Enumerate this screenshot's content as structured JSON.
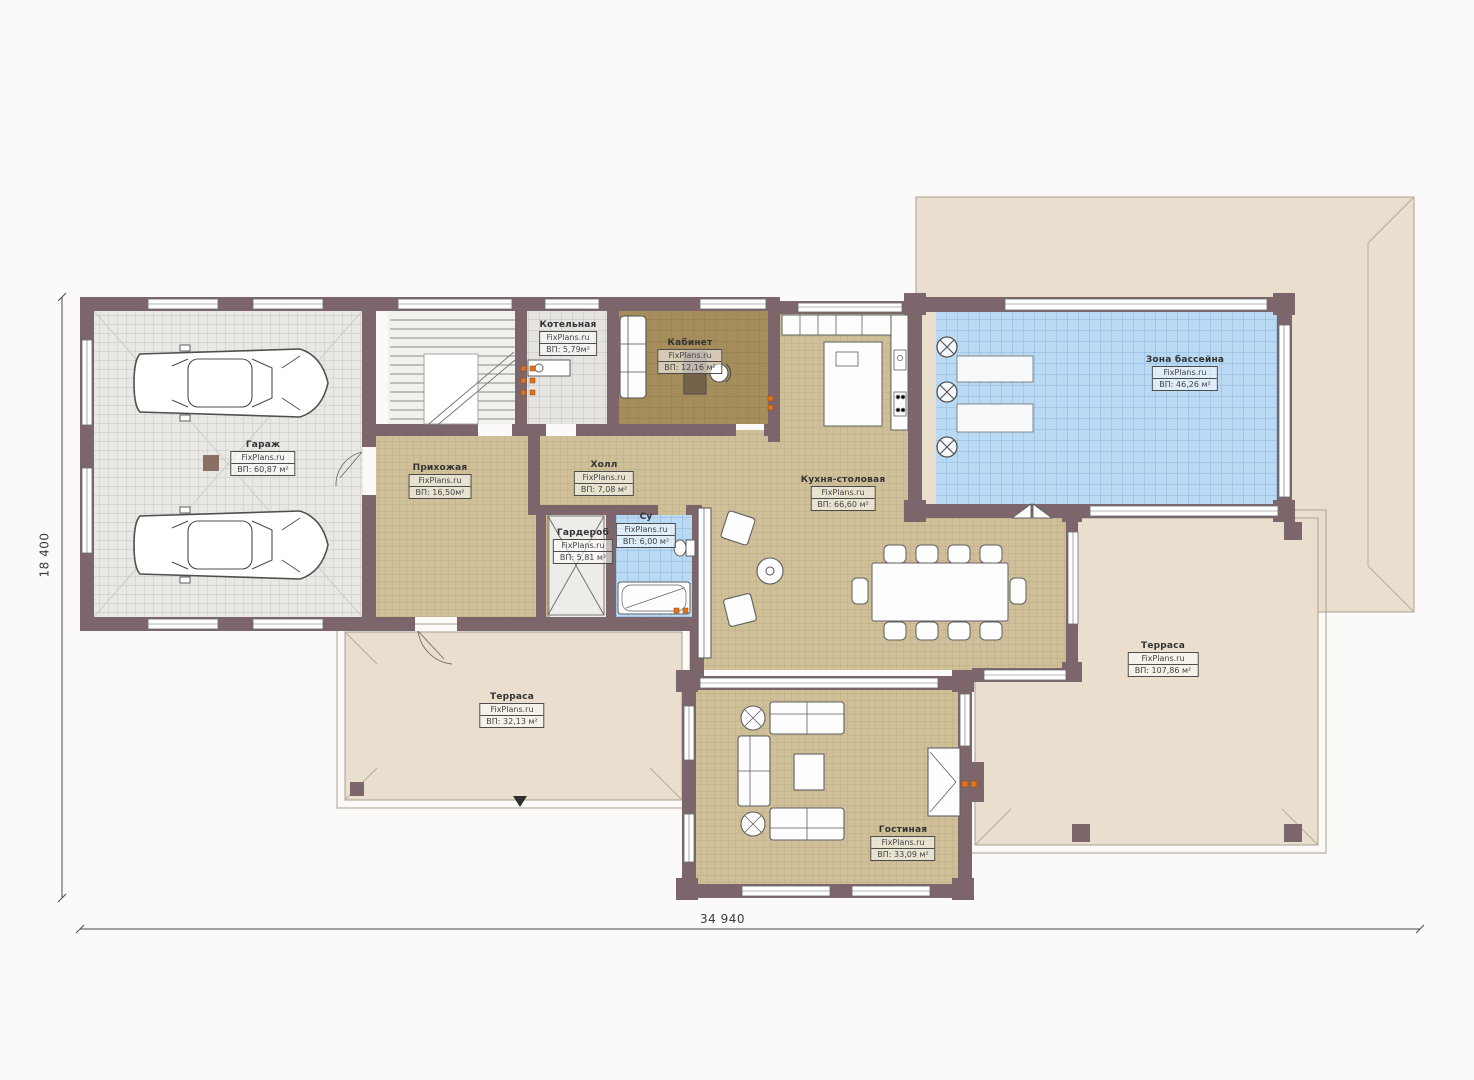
{
  "plan": {
    "brand": "FixPlans.ru",
    "dimensions": {
      "width": "34 940",
      "height": "18 400"
    },
    "rooms": [
      {
        "id": "garage",
        "name": "Гараж",
        "area": "ВП: 60,87 м²"
      },
      {
        "id": "boiler",
        "name": "Котельная",
        "area": "ВП: 5,79м²"
      },
      {
        "id": "office",
        "name": "Кабинет",
        "area": "ВП: 12,16 м²"
      },
      {
        "id": "entry",
        "name": "Прихожая",
        "area": "ВП: 16,50м²"
      },
      {
        "id": "hall",
        "name": "Холл",
        "area": "ВП: 7,08 м²"
      },
      {
        "id": "wardrobe",
        "name": "Гардероб",
        "area": "ВП: 5,81 м²"
      },
      {
        "id": "wc",
        "name": "Су",
        "area": "ВП: 6,00 м²"
      },
      {
        "id": "kitchen",
        "name": "Кухня-столовая",
        "area": "ВП: 66,60 м²"
      },
      {
        "id": "pool",
        "name": "Зона бассейна",
        "area": "ВП: 46,26 м²"
      },
      {
        "id": "terrace-left",
        "name": "Терраса",
        "area": "ВП: 32,13 м²"
      },
      {
        "id": "terrace-right",
        "name": "Терраса",
        "area": "ВП: 107,86 м²"
      },
      {
        "id": "living",
        "name": "Гостиная",
        "area": "ВП: 33,09 м²"
      }
    ],
    "colors": {
      "wall": "#7d666b",
      "floor_tan": "#cfc099",
      "floor_gray": "#e9e8e4",
      "floor_blue": "#badaf4",
      "floor_office": "#a68d5c",
      "terrace_beige": "#eadfce",
      "radiator_orange": "#e2731d"
    }
  }
}
